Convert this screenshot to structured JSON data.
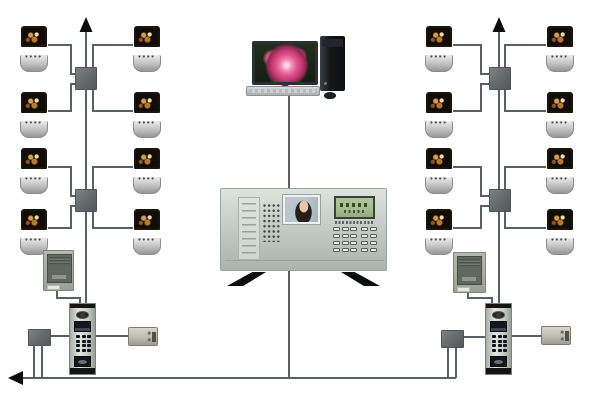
{
  "title": "Building video intercom system wiring diagram",
  "colors": {
    "background": "#ffffff",
    "wire": "#5b6064",
    "arrow": "#0d0d0d",
    "junction_box": "#63686b",
    "monitor_body": "#c9c9c9",
    "monitor_screen": "#120c06",
    "panel_body": "#c6cfc9",
    "lcd_screen": "#a4bd8e",
    "rose_pink": "#e0588e",
    "door_station_silver": "#c9cdc9",
    "psu_front": "#60695f",
    "lock_beige": "#bcbcb0"
  },
  "components": {
    "indoor_monitors": {
      "label": "indoor video monitor unit",
      "count": 16
    },
    "floor_junction_boxes": {
      "label": "floor distributor junction box",
      "count": 4
    },
    "entry_junction_boxes": {
      "label": "entry junction box",
      "count": 2
    },
    "power_supplies": {
      "label": "power supply unit",
      "count": 2
    },
    "door_stations": {
      "label": "outdoor door station with camera and keypad",
      "count": 2
    },
    "electric_locks": {
      "label": "electric door lock",
      "count": 2
    },
    "computer": {
      "label": "management computer with rose wallpaper, tower, keyboard and mouse",
      "count": 1
    },
    "guard_station": {
      "label": "guard management console with portrait screen, LCD and keypad",
      "count": 1
    },
    "risers": {
      "label": "riser trunk line with upward arrow",
      "count": 2
    },
    "bus": {
      "label": "bottom bus line with left arrow",
      "count": 1
    }
  }
}
